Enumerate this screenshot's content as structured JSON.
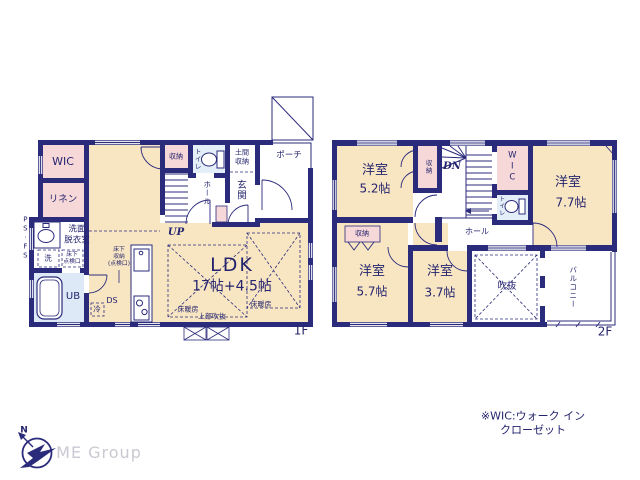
{
  "colors": {
    "wall": "#2b2b7c",
    "room_tan": "#f8e6c3",
    "room_pink": "#f7d8d8",
    "room_blue": "#dde9f6",
    "text_navy": "#24246e",
    "logo_gray": "#c9c9d2"
  },
  "floor1": {
    "label": "1F",
    "wic": "WIC",
    "linen": "リネン",
    "ps_fs": "PS·FS",
    "washroom": "洗面\n脱衣室",
    "laundry": "洗",
    "underfloor_hatch": "床下\n点検口",
    "unit_bath": "UB",
    "underfloor_storage": "床下\n収納\n(点検口)",
    "duct_space": "DS",
    "fridge": "冷",
    "storage": "収納",
    "toilet": "トイレ",
    "doma_storage": "土間\n収納",
    "porch": "ポーチ",
    "hall": "ホール",
    "entrance": "玄関",
    "stairs": "UP",
    "ldk_name": "LDK",
    "ldk_size": "17帖+4.5帖",
    "floor_heating_left": "床暖房",
    "floor_heating_right": "床暖房",
    "upper_void": "上部吹抜"
  },
  "floor2": {
    "label": "2F",
    "room_a_name": "洋室",
    "room_a_size": "5.2帖",
    "stair_closet": "収納",
    "stairs": "DN",
    "wic": "WIC",
    "room_b_name": "洋室",
    "room_b_size": "7.7帖",
    "toilet": "トイレ",
    "hall": "ホール",
    "closet": "収納",
    "room_c_name": "洋室",
    "room_c_size": "5.7帖",
    "room_d_name": "洋室",
    "room_d_size": "3.7帖",
    "void": "吹抜",
    "balcony": "バルコニー"
  },
  "footer": {
    "note": "※WIC:ウォーク イン クローゼット",
    "company": "ME Group",
    "compass_north": "N"
  }
}
